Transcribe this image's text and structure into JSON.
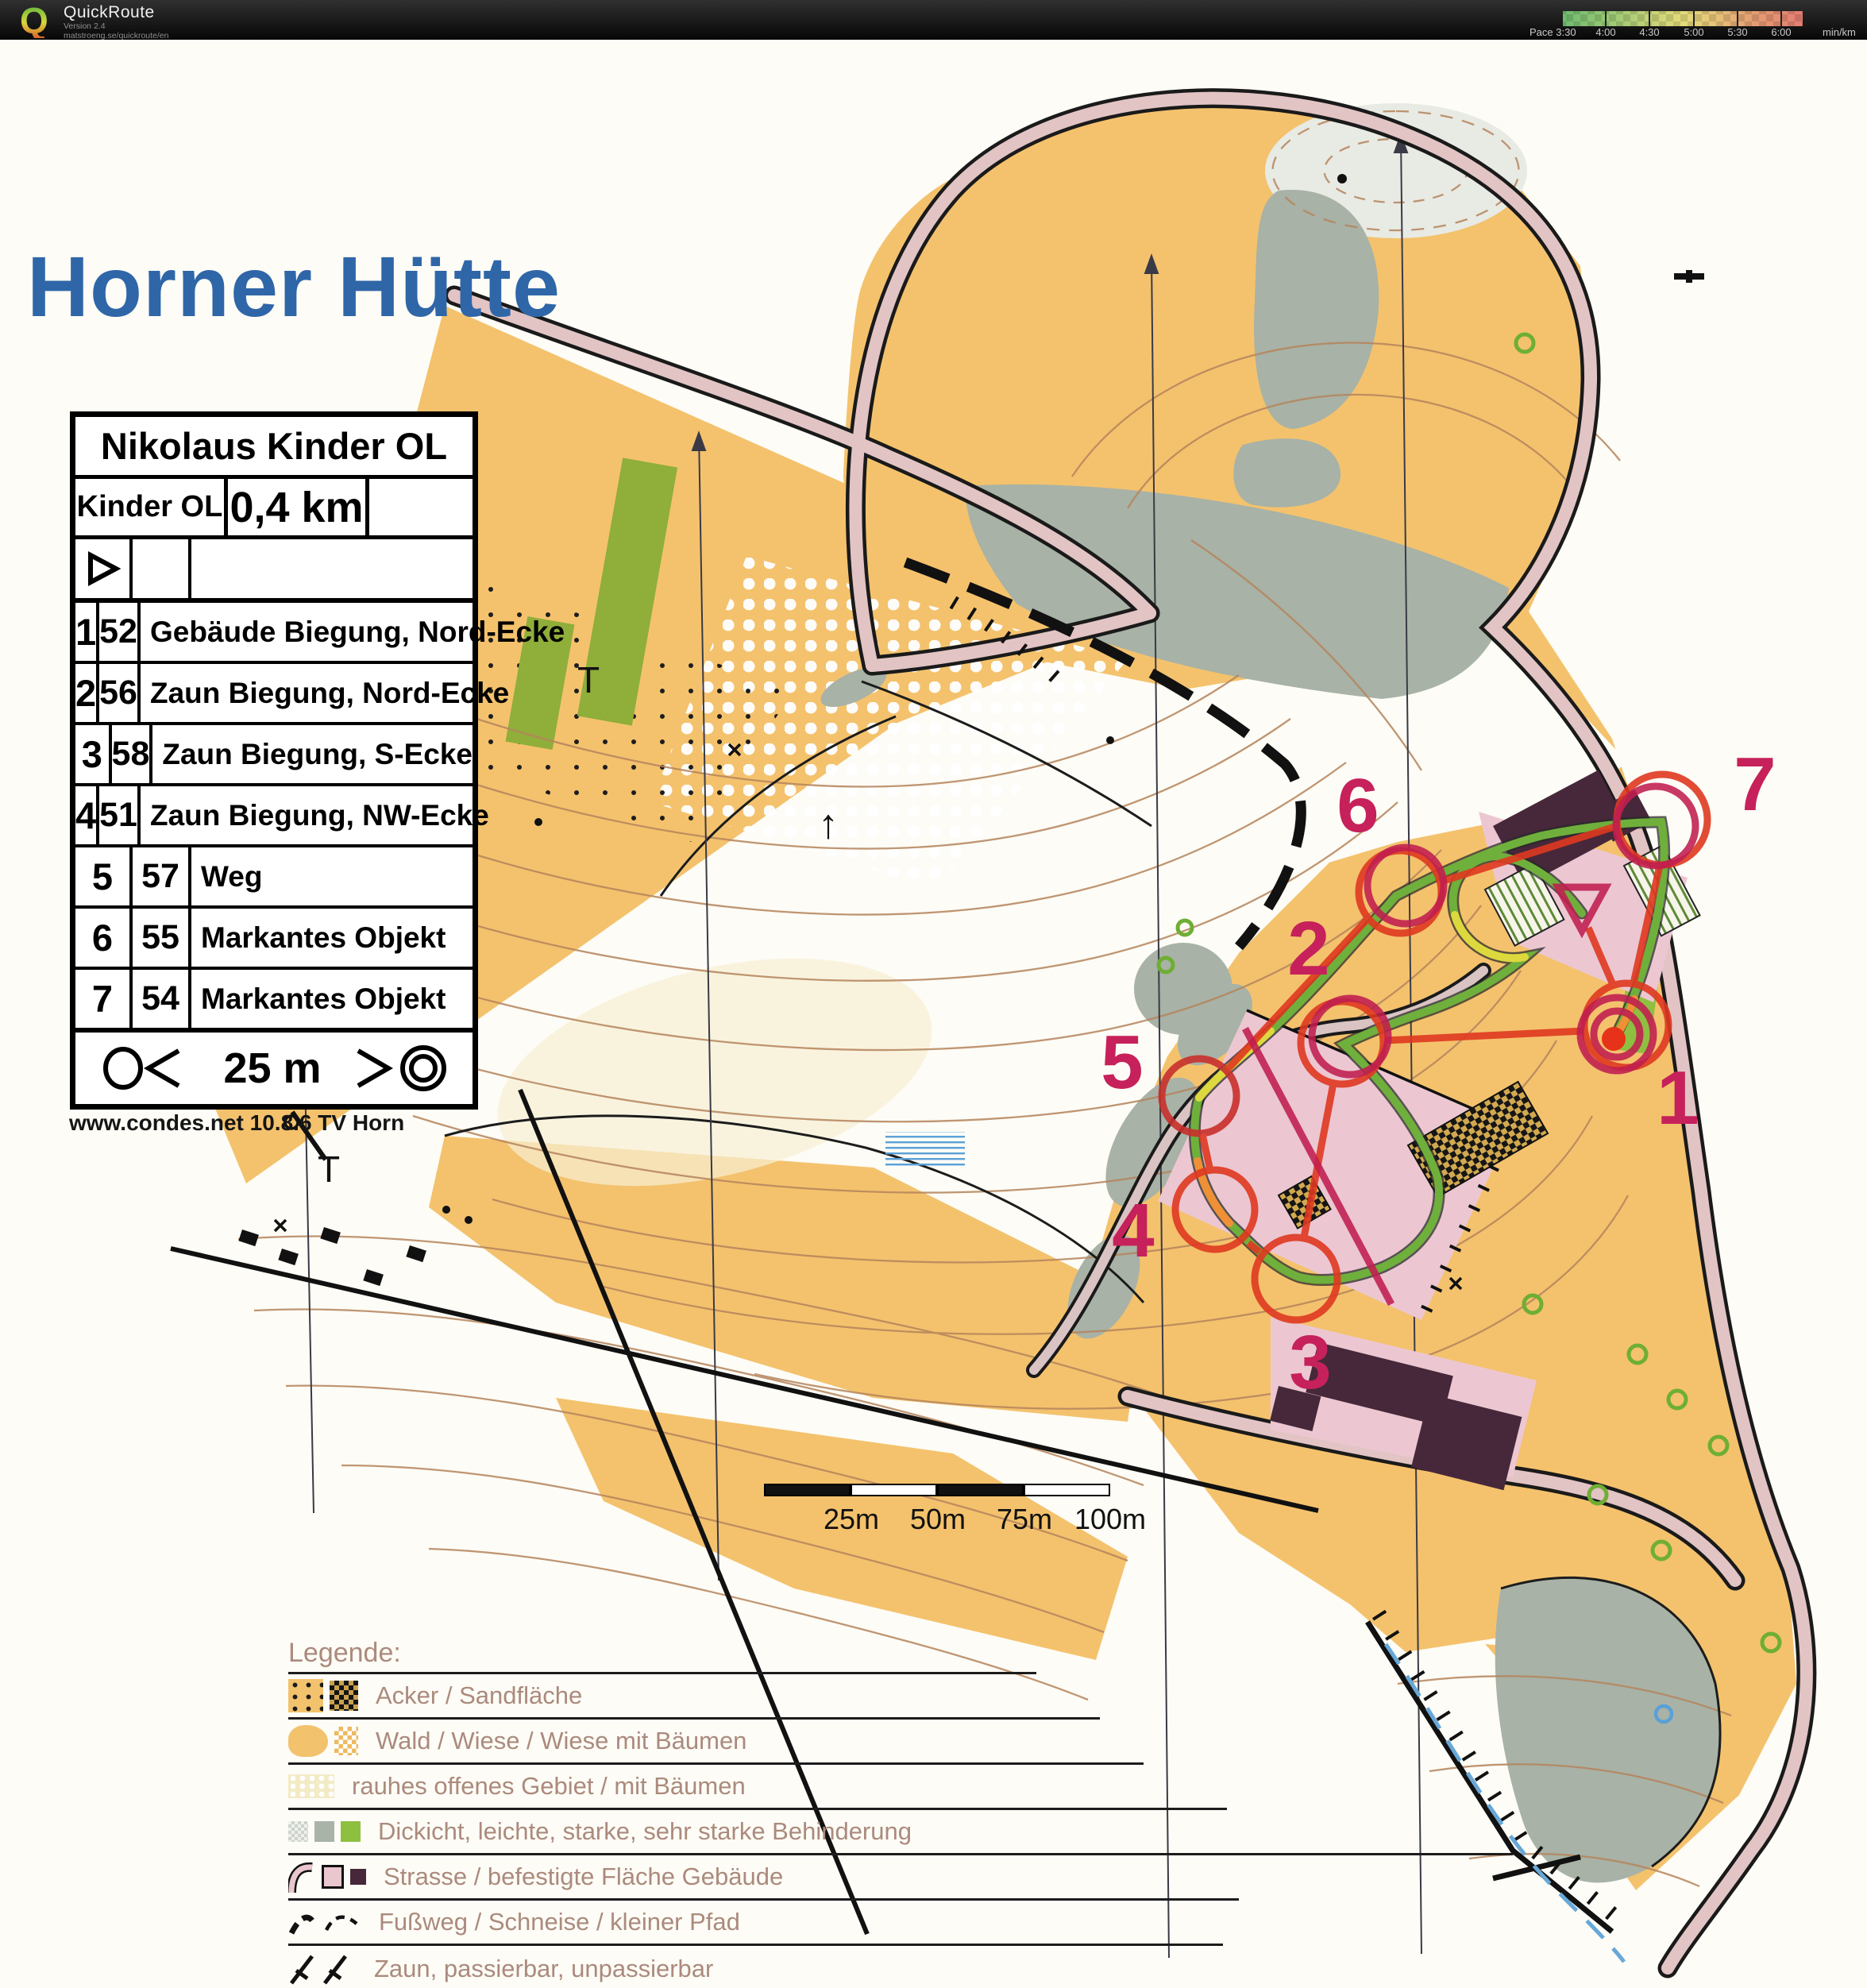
{
  "header": {
    "app_name": "QuickRoute",
    "version": "Version 2.4",
    "url": "matstroeng.se/quickroute/en",
    "pace_scale": {
      "prefix": "Pace",
      "ticks": [
        "3:30",
        "4:00",
        "4:30",
        "5:00",
        "5:30",
        "6:00"
      ],
      "unit": "min/km",
      "gradient": [
        "#6fbc6f",
        "#96c873",
        "#c9d378",
        "#e3dc79",
        "#e5c678",
        "#e5a072",
        "#e57d72"
      ]
    }
  },
  "map": {
    "title": "Horner Hütte",
    "title_color": "#2f66a8",
    "credit": "www.condes.net 10.8.6 TV Horn",
    "control_card": {
      "event_title": "Nikolaus Kinder OL",
      "course_name": "Kinder OL",
      "course_length": "0,4 km",
      "rows": [
        {
          "num": "1",
          "code": "52",
          "desc": "Gebäude Biegung, Nord-Ecke"
        },
        {
          "num": "2",
          "code": "56",
          "desc": "Zaun Biegung, Nord-Ecke"
        },
        {
          "num": "3",
          "code": "58",
          "desc": "Zaun Biegung, S-Ecke"
        },
        {
          "num": "4",
          "code": "51",
          "desc": "Zaun Biegung, NW-Ecke"
        },
        {
          "num": "5",
          "code": "57",
          "desc": "Weg"
        },
        {
          "num": "6",
          "code": "55",
          "desc": "Markantes Objekt"
        },
        {
          "num": "7",
          "code": "54",
          "desc": "Markantes Objekt"
        }
      ],
      "footer_distance": "25 m"
    },
    "scale_bar": {
      "labels": [
        "25m",
        "50m",
        "75m",
        "100m"
      ]
    },
    "course_numbers": [
      "1",
      "2",
      "3",
      "4",
      "5",
      "6",
      "7"
    ],
    "map_letters": {
      "t1": "T",
      "t2": "T"
    },
    "course_colors": {
      "circle": "#df3920",
      "overprint": "#c01e50"
    },
    "legend": {
      "title": "Legende:",
      "items": [
        "Acker / Sandfläche",
        "Wald / Wiese / Wiese mit Bäumen",
        "rauhes offenes Gebiet / mit Bäumen",
        "Dickicht, leichte, starke, sehr starke Behinderung",
        "Strasse / befestigte Fläche Gebäude",
        "Fußweg / Schneise / kleiner Pfad",
        "Zaun, passierbar, unpassierbar"
      ]
    }
  }
}
